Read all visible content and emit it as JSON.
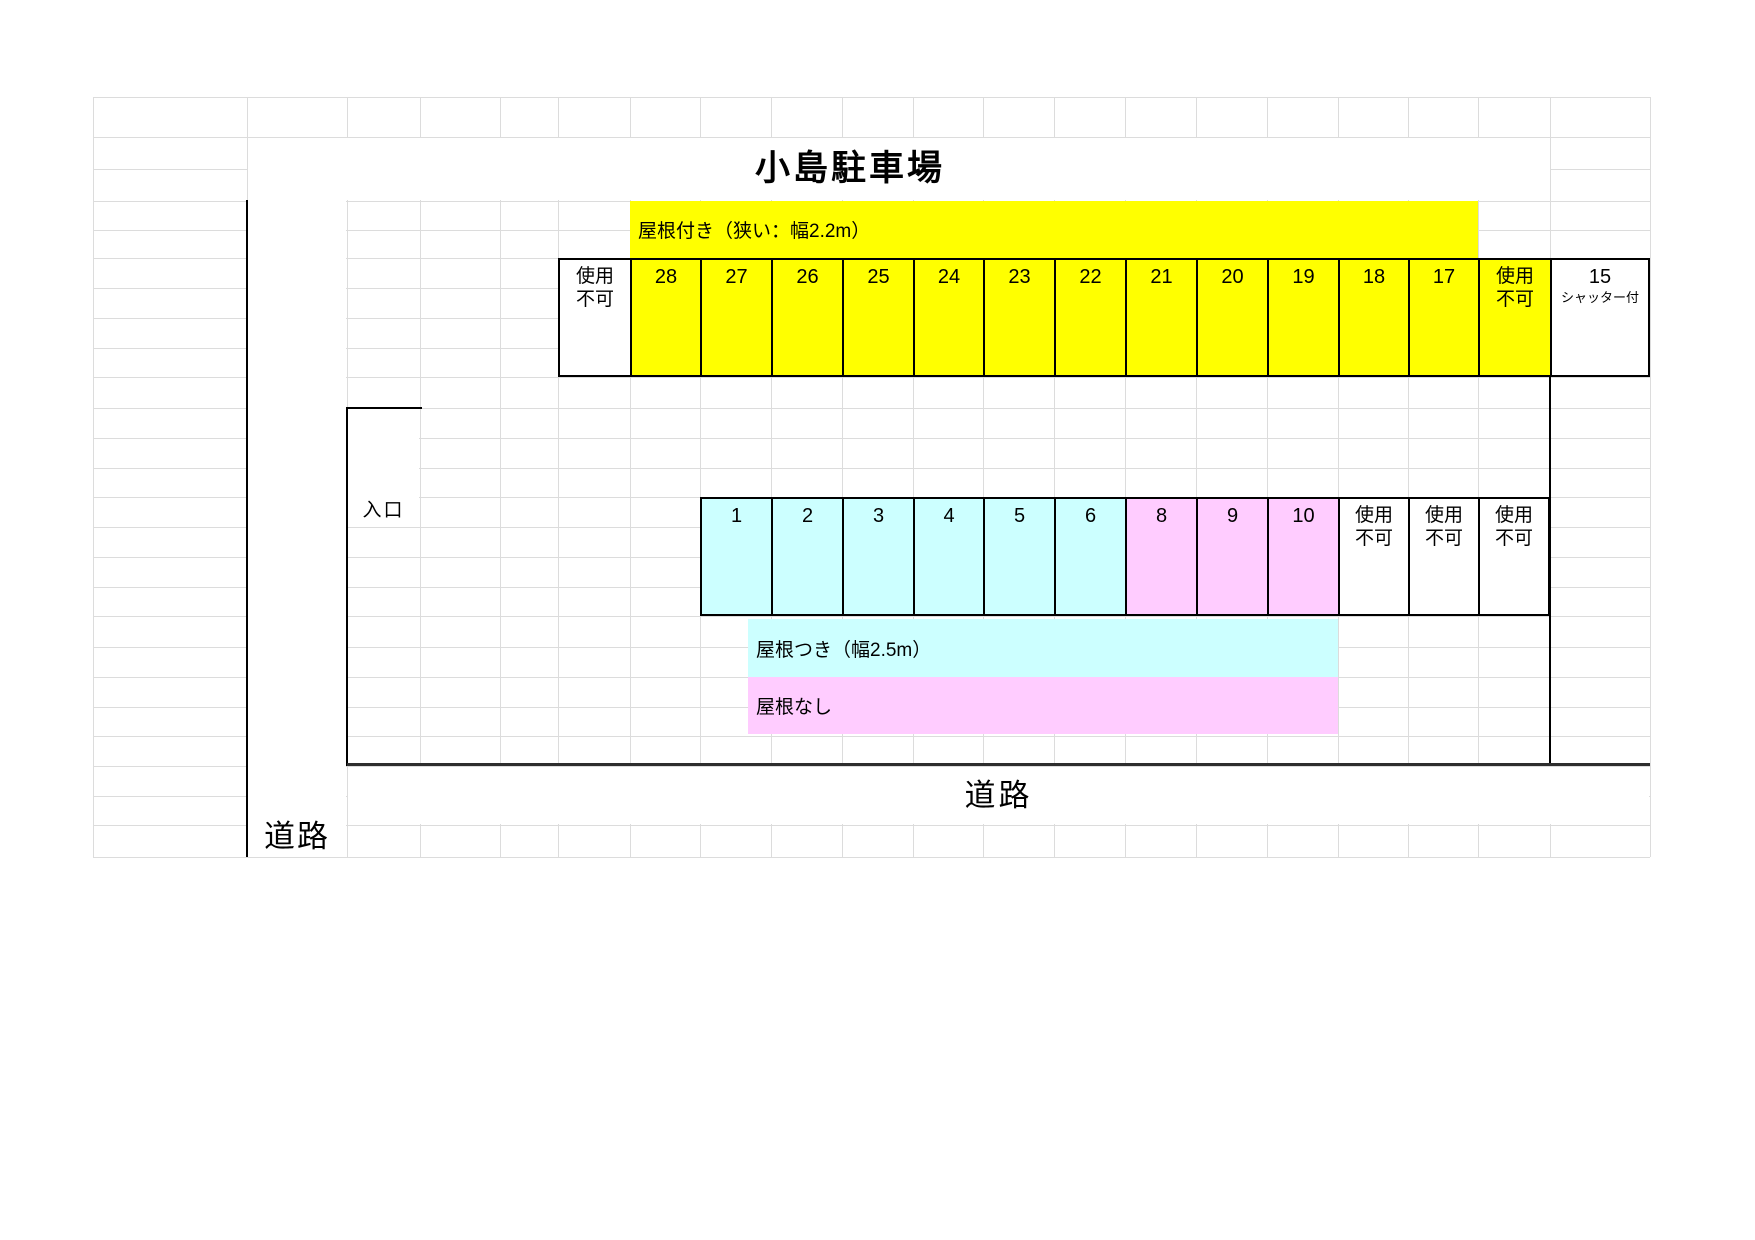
{
  "colors": {
    "yellow": "#FFFF00",
    "cyan": "#CCFFFF",
    "pink": "#FFCCFF",
    "white": "#FFFFFF",
    "gridline": "#DCDCDC"
  },
  "title": "小島駐車場",
  "top_banner": {
    "label": "屋根付き（狭い：幅2.2m）"
  },
  "top_row": {
    "cells": [
      {
        "label": "使用不可",
        "fill": "white"
      },
      {
        "label": "28",
        "fill": "yellow"
      },
      {
        "label": "27",
        "fill": "yellow"
      },
      {
        "label": "26",
        "fill": "yellow"
      },
      {
        "label": "25",
        "fill": "yellow"
      },
      {
        "label": "24",
        "fill": "yellow"
      },
      {
        "label": "23",
        "fill": "yellow"
      },
      {
        "label": "22",
        "fill": "yellow"
      },
      {
        "label": "21",
        "fill": "yellow"
      },
      {
        "label": "20",
        "fill": "yellow"
      },
      {
        "label": "19",
        "fill": "yellow"
      },
      {
        "label": "18",
        "fill": "yellow"
      },
      {
        "label": "17",
        "fill": "yellow"
      },
      {
        "label": "使用不可",
        "fill": "yellow"
      },
      {
        "label": "15",
        "sublabel": "シャッター付",
        "fill": "white"
      }
    ]
  },
  "middle_row": {
    "cells": [
      {
        "label": "1",
        "fill": "cyan"
      },
      {
        "label": "2",
        "fill": "cyan"
      },
      {
        "label": "3",
        "fill": "cyan"
      },
      {
        "label": "4",
        "fill": "cyan"
      },
      {
        "label": "5",
        "fill": "cyan"
      },
      {
        "label": "6",
        "fill": "cyan"
      },
      {
        "label": "8",
        "fill": "pink"
      },
      {
        "label": "9",
        "fill": "pink"
      },
      {
        "label": "10",
        "fill": "pink"
      },
      {
        "label": "使用不可",
        "fill": "white"
      },
      {
        "label": "使用不可",
        "fill": "white"
      },
      {
        "label": "使用不可",
        "fill": "white"
      }
    ]
  },
  "legend": {
    "covered": {
      "label": "屋根つき（幅2.5m）",
      "fill": "cyan"
    },
    "uncovered": {
      "label": "屋根なし",
      "fill": "pink"
    }
  },
  "entrance_label": "入口",
  "road_bottom_label": "道路",
  "road_left_label": "道路"
}
